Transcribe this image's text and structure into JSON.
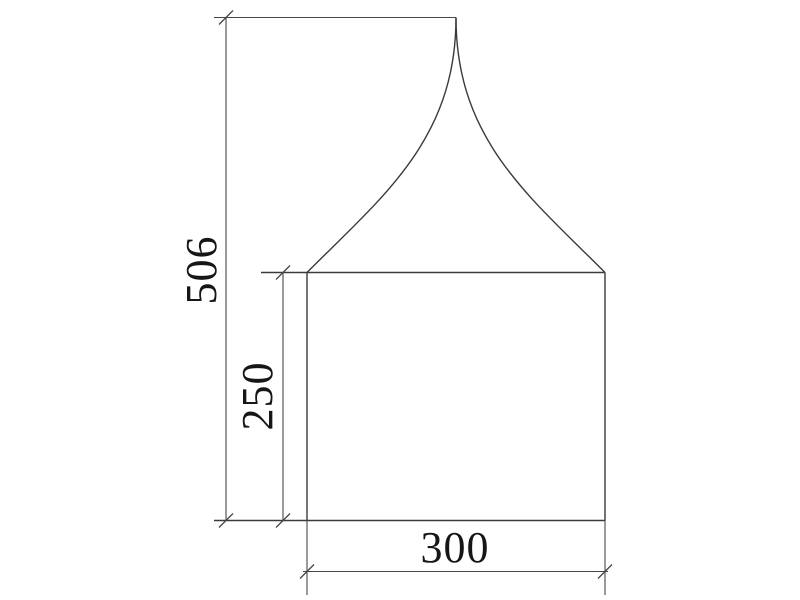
{
  "page": {
    "background_color": "#ffffff"
  },
  "drawing": {
    "description": "front elevation of a pagoda tent with flared peaked roof over a rectangular body",
    "line_color": "#3a3a3a",
    "text_color": "#161616",
    "dimensions": {
      "total_height": {
        "value": "506",
        "orientation": "vertical"
      },
      "wall_height": {
        "value": "250",
        "orientation": "vertical"
      },
      "base_width": {
        "value": "300",
        "orientation": "horizontal"
      }
    }
  }
}
